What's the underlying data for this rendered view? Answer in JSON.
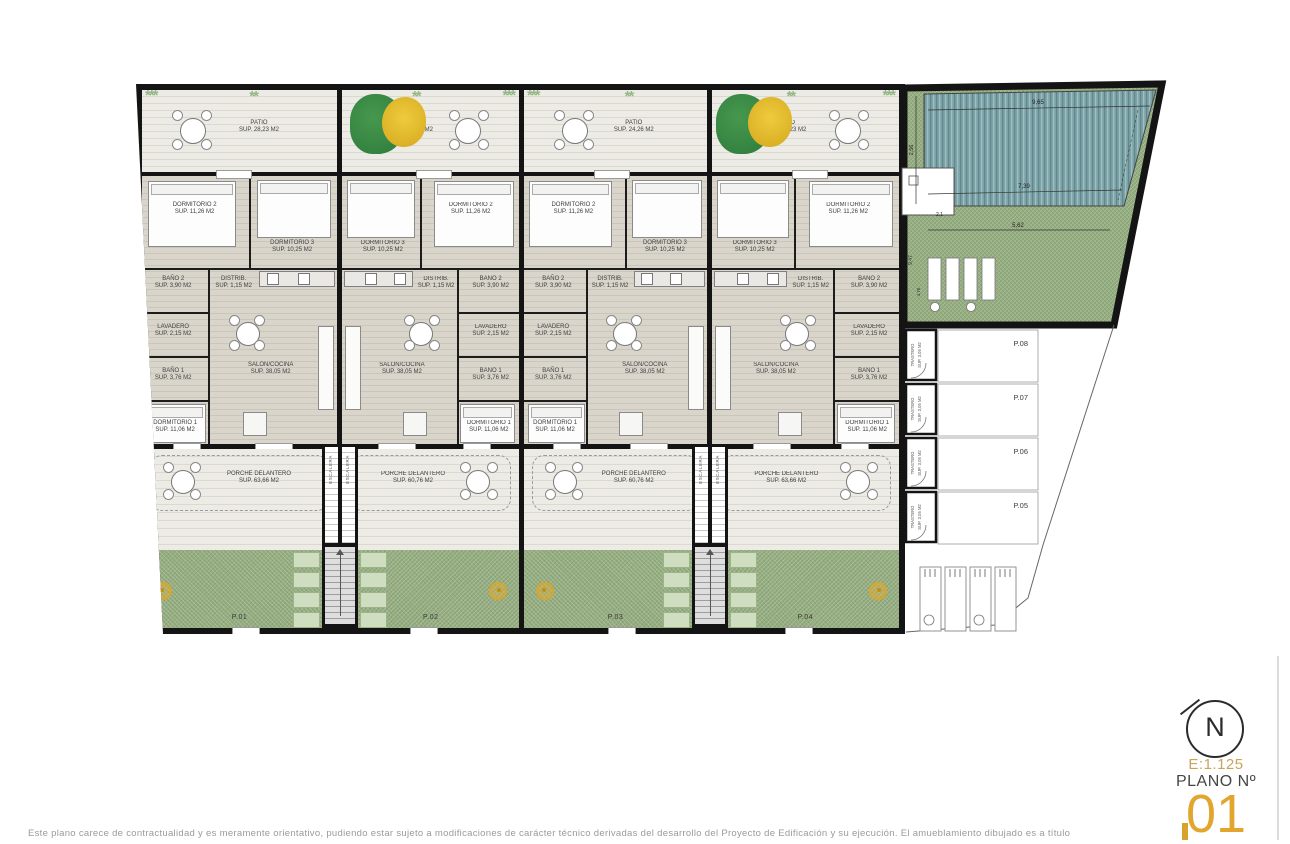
{
  "title_block": {
    "north": "N",
    "scale": "E:1.125",
    "plano_label": "PLANO Nº",
    "plano_number": "01"
  },
  "disclaimer": "Este plano carece de contractualidad y es meramente orientativo, pudiendo estar sujeto a modificaciones de carácter técnico derivadas del desarrollo del Proyecto de Edificación y su ejecución. El amueblamiento dibujado es a título",
  "room_labels": {
    "patio": "PATIO",
    "dorm2": "DORMITORIO 2",
    "dorm2_sup": "SUP. 11,26 M2",
    "dorm3": "DORMITORIO 3",
    "dorm3_sup": "SUP. 10,25 M2",
    "dorm1": "DORMITORIO 1",
    "dorm1_sup": "SUP. 11,06 M2",
    "bano2": "BAÑO 2",
    "bano2_sup": "SUP. 3,90 M2",
    "bano1": "BAÑO 1",
    "bano1_sup": "SUP. 3,76 M2",
    "distrib": "DISTRIB.",
    "distrib_sup": "SUP. 1,15 M2",
    "lavadero": "LAVADERO",
    "lavadero_sup": "SUP. 2,15 M2",
    "salon": "SALON/COCINA",
    "salon_sup": "SUP. 38,05 M2",
    "porche": "PORCHE DELANTERO",
    "escalera": "ESCALERA",
    "trastero": "TRASTERO",
    "trastero_sup": "SUP. 3,05 M2"
  },
  "units": [
    {
      "id": "P.01",
      "mirrored": false,
      "patio_sup": "SUP. 28,23 M2",
      "porche_sup": "SUP. 63,66 M2"
    },
    {
      "id": "P.02",
      "mirrored": true,
      "patio_sup": "SUP. 24,26 M2",
      "porche_sup": "SUP. 60,76 M2"
    },
    {
      "id": "P.03",
      "mirrored": false,
      "patio_sup": "SUP. 24,26 M2",
      "porche_sup": "SUP. 60,76 M2"
    },
    {
      "id": "P.04",
      "mirrored": true,
      "patio_sup": "SUP. 28,23 M2",
      "porche_sup": "SUP. 63,66 M2"
    }
  ],
  "plots": [
    {
      "id": "P.08"
    },
    {
      "id": "P.07"
    },
    {
      "id": "P.06"
    },
    {
      "id": "P.05"
    }
  ],
  "pool_dims": {
    "top": "9,65",
    "mid": "7,39",
    "bottom": "5,62",
    "left": "2,56",
    "small": "2,1",
    "side": "9,47",
    "low": "4,76"
  },
  "colors": {
    "accent_gold": "#E2A62E",
    "garden_green": "#94AD7F",
    "pool_teal": "#7BA3A8",
    "wall": "#141414"
  }
}
